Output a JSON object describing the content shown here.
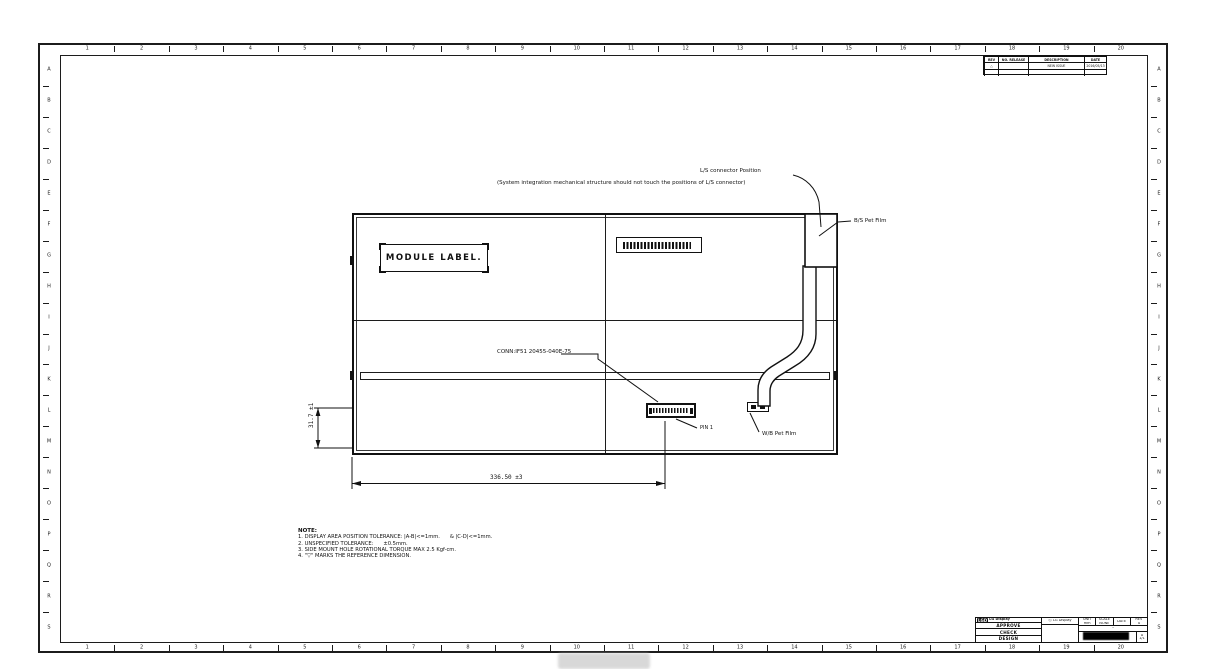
{
  "drawing": {
    "zone_columns": [
      "1",
      "2",
      "3",
      "4",
      "5",
      "6",
      "7",
      "8",
      "9",
      "10",
      "11",
      "12",
      "13",
      "14",
      "15",
      "16",
      "17",
      "18",
      "19",
      "20"
    ],
    "zone_rows": [
      "A",
      "B",
      "C",
      "D",
      "E",
      "F",
      "G",
      "H",
      "I",
      "J",
      "K",
      "L",
      "M",
      "N",
      "O",
      "P",
      "Q",
      "R",
      "S"
    ],
    "module_label": "MODULE LABEL.",
    "annotations": {
      "ls_connector_position": "L/S connector Position",
      "system_note": "(System integration mechanical structure should not touch the positions of L/S connector)",
      "bs_pet_film": "B/S Pet Film",
      "wb_pet_film": "W/B Pet Film",
      "conn_label": "CONN:IF51 20455-040E-75",
      "pin1": "PIN 1",
      "dim_width": "336.50 ±3",
      "dim_height": "31.7 ±1"
    },
    "notes": {
      "title": "NOTE:",
      "items": [
        "1. DISPLAY AREA POSITION TOLERANCE: |A-B|<=1mm.      & |C-D|<=1mm.",
        "2. UNSPECIFIED TOLERANCE:      ±0.5mm.",
        "3. SIDE MOUNT HOLE ROTATIONAL TORQUE MAX 2.5 Kgf-cm.",
        "4. \"▽\" MARKS THE REFERENCE DIMENSION."
      ]
    },
    "revision_table": {
      "headers": [
        "REV",
        "NO. RELEASE",
        "DESCRIPTION",
        "DATE"
      ],
      "rows": [
        [
          "△",
          "",
          "NEW ISSUE",
          "2016/05/13"
        ],
        [
          "",
          "",
          "",
          ""
        ]
      ]
    },
    "title_block": {
      "logo": "LGD",
      "company_name": "LG Display",
      "copyright": "ⓒ LG Display",
      "sign_rows": [
        "APPROVE",
        "CHECK",
        "DESIGN"
      ],
      "info_cells": [
        {
          "label": "UNIT",
          "value": "mm"
        },
        {
          "label": "SCALE",
          "value": "NONE"
        },
        {
          "label": "DATE",
          "value": ""
        },
        {
          "label": "REV",
          "value": "A"
        }
      ],
      "title_value": "-",
      "rev_value": "A",
      "sheet_value": "1/1"
    }
  }
}
